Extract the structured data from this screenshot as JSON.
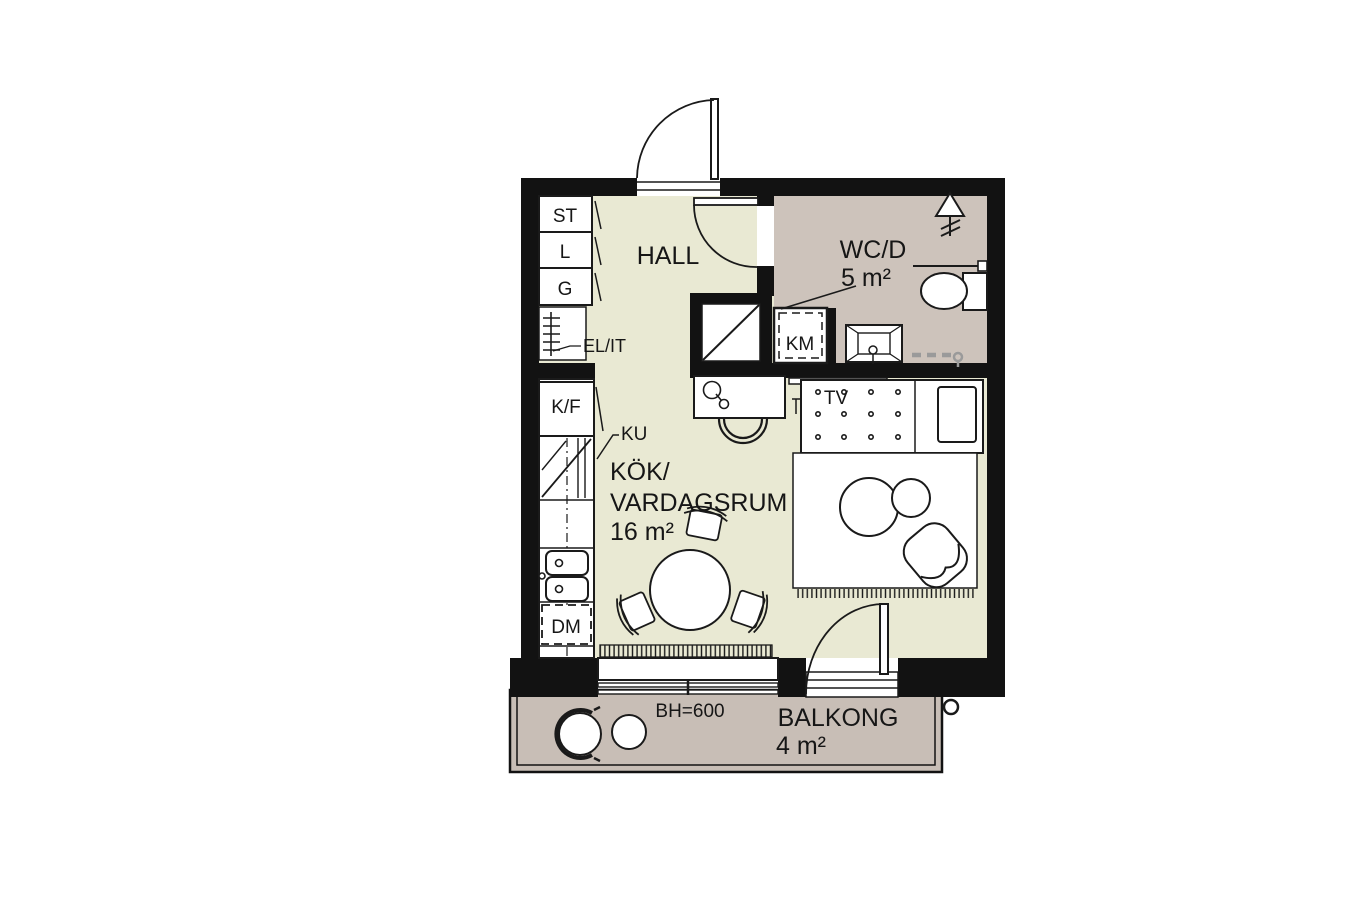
{
  "meta": {
    "type": "apartment-floor-plan"
  },
  "rooms": {
    "hall": {
      "label": "HALL"
    },
    "wc": {
      "label": "WC/D",
      "area": "5 m²"
    },
    "kitchen_living": {
      "line1": "KÖK/",
      "line2": "VARDAGSRUM",
      "area": "16 m²"
    },
    "balcony": {
      "label": "BALKONG",
      "area": "4 m²",
      "sill_height": "BH=600"
    }
  },
  "fixtures": {
    "closet_cleaning": "ST",
    "closet_linen": "L",
    "closet_wardrobe": "G",
    "electrical_cabinet": "EL/IT",
    "fridge_freezer": "K/F",
    "cooktop": "KU",
    "dishwasher": "DM",
    "washer": "KM",
    "tv": "TV"
  },
  "colors": {
    "background": "#ffffff",
    "wall": "#121212",
    "line": "#1a1a1a",
    "floor_main": "#e9e9d3",
    "floor_wet": "#cdc3bb",
    "floor_balcony": "#c8beb6",
    "furniture_fill": "#ffffff",
    "towel_rail_gray": "#9a9a9a"
  }
}
